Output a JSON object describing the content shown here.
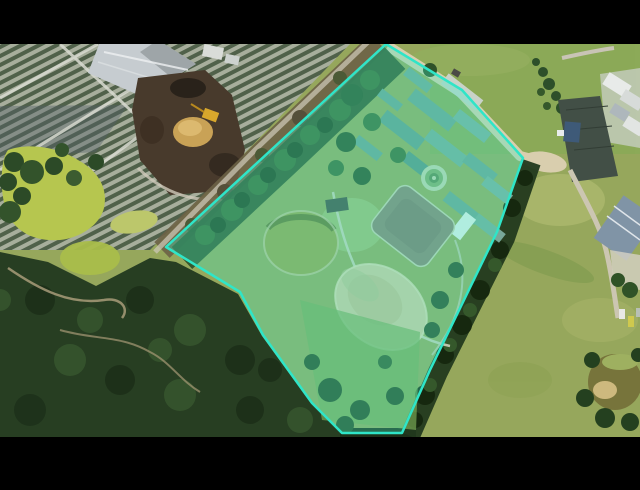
{
  "scene": {
    "type": "aerial-photo-with-parcel-overlay",
    "letterbox_color": "#000000",
    "photo_area": {
      "top": 44,
      "bottom": 437,
      "left": 0,
      "right": 640
    }
  },
  "parcel": {
    "points": "386,44 462,90 523,158 497,232 430,370 402,433 342,433 312,403 263,335 240,292 166,247",
    "fill": "rgba(62,235,198,0.32)",
    "stroke": "#2fe5c8",
    "stroke_width": "2.5"
  },
  "palette": {
    "highlight_turquoise": "#2fe5c8",
    "grass_field": "#9aa95e",
    "bright_grass": "#86ab55",
    "forest_dark": "#273e22",
    "algae_pond": "#b6c64f",
    "sandy_dam": "#d5c89e",
    "compost_brown": "#483a2c",
    "warehouse_roof": "#c6ccd0",
    "greenhouse_teal": "#6fa092",
    "dirt_road_tan": "#d9ceae",
    "house_roof_blue_gray": "#8094a6"
  },
  "features": [
    "highlighted-parcel-boundary",
    "nursery-rows",
    "warehouse-roof",
    "compost-yard",
    "excavator",
    "algae-pond",
    "forest",
    "greenhouse-cluster",
    "circular-garden",
    "paddock",
    "sandy-dam",
    "grass-field",
    "dirt-road",
    "houses",
    "farm-pond"
  ]
}
